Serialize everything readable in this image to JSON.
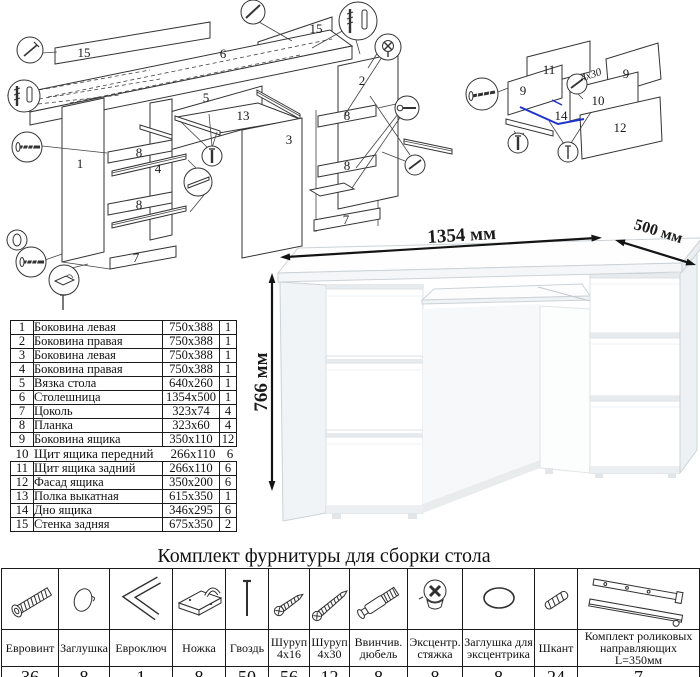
{
  "diagram": {
    "nums": {
      "n1": "1",
      "n2": "2",
      "n3": "3",
      "n4": "4",
      "n5": "5",
      "n6": "6",
      "n7": "7",
      "n8": "8",
      "n9": "9",
      "n10": "10",
      "n11": "11",
      "n12": "12",
      "n13": "13",
      "n14": "14",
      "n15": "15"
    },
    "screw_note": "4х30"
  },
  "desk": {
    "width_label": "1354 мм",
    "depth_label": "500 мм",
    "height_label": "766 мм"
  },
  "parts": {
    "rows": [
      {
        "n": "1",
        "name": "Боковина левая",
        "size": "750x388",
        "q": "1"
      },
      {
        "n": "2",
        "name": "Боковина правая",
        "size": "750x388",
        "q": "1"
      },
      {
        "n": "3",
        "name": "Боковина левая",
        "size": "750x388",
        "q": "1"
      },
      {
        "n": "4",
        "name": "Боковина правая",
        "size": "750x388",
        "q": "1"
      },
      {
        "n": "5",
        "name": "Вязка стола",
        "size": "640x260",
        "q": "1"
      },
      {
        "n": "6",
        "name": "Столешница",
        "size": "1354x500",
        "q": "1"
      },
      {
        "n": "7",
        "name": "Цоколь",
        "size": "323x74",
        "q": "4"
      },
      {
        "n": "8",
        "name": "Планка",
        "size": "323x60",
        "q": "4"
      },
      {
        "n": "9",
        "name": "Боковина ящика",
        "size": "350x110",
        "q": "12"
      },
      {
        "n": "10",
        "name": "Щит ящика передний",
        "size": "266x110",
        "q": "6"
      },
      {
        "n": "11",
        "name": "Щит ящика задний",
        "size": "266x110",
        "q": "6"
      },
      {
        "n": "12",
        "name": "Фасад ящика",
        "size": "350x200",
        "q": "6"
      },
      {
        "n": "13",
        "name": "Полка выкатная",
        "size": "615x350",
        "q": "1"
      },
      {
        "n": "14",
        "name": "Дно ящика",
        "size": "346x295",
        "q": "6"
      },
      {
        "n": "15",
        "name": "Стенка задняя",
        "size": "675x350",
        "q": "2"
      }
    ]
  },
  "hardware": {
    "title": "Комплект фурнитуры для сборки стола",
    "items": [
      {
        "icon": "euro-screw",
        "label": "Евровинт",
        "qty": "36"
      },
      {
        "icon": "furniture-cap",
        "label": "Заглушка",
        "qty": "8"
      },
      {
        "icon": "hex-key",
        "label": "Евроключ",
        "qty": "1"
      },
      {
        "icon": "furniture-foot",
        "label": "Ножка",
        "qty": "8"
      },
      {
        "icon": "nail",
        "label": "Гвоздь",
        "qty": "50"
      },
      {
        "icon": "screw-4x16",
        "label": "Шуруп 4х16",
        "qty": "56"
      },
      {
        "icon": "screw-4x30",
        "label": "Шуруп 4х30",
        "qty": "12"
      },
      {
        "icon": "screw-in-dowel",
        "label": "Ввинчив. дюбель",
        "qty": "8"
      },
      {
        "icon": "cam-lock",
        "label": "Эксцентр. стяжка",
        "qty": "8"
      },
      {
        "icon": "cam-cap",
        "label": "Заглушка для эксцентрика",
        "qty": "8"
      },
      {
        "icon": "wood-dowel",
        "label": "Шкант",
        "qty": "24"
      },
      {
        "icon": "roller-slides",
        "label": "Комплект роликовых направляющих L=350мм",
        "qty": "7"
      }
    ]
  }
}
